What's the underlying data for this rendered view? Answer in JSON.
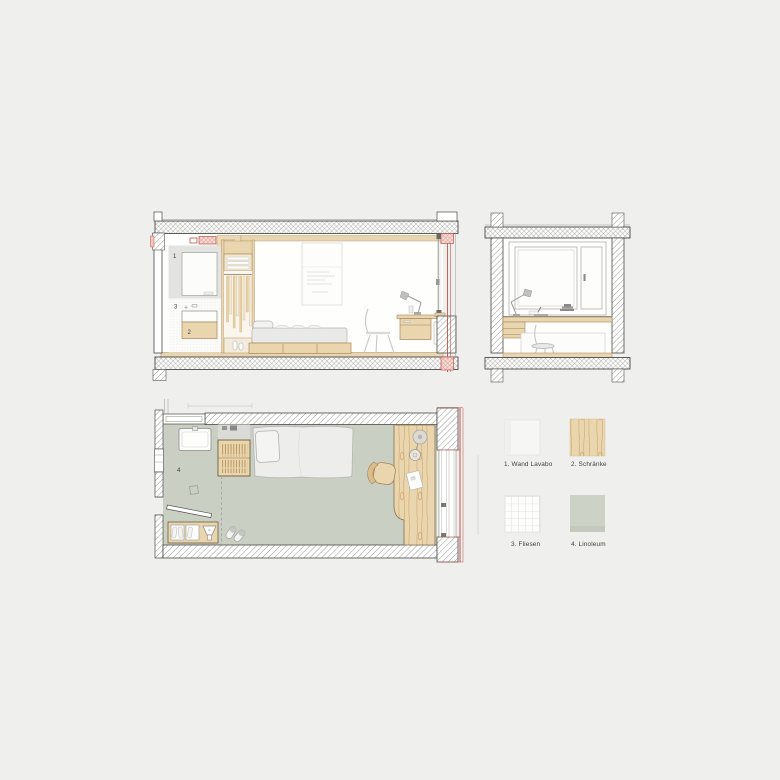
{
  "background": "#efefed",
  "palette": {
    "wood": "#e9d5ae",
    "wood_line": "#b08a55",
    "linoleum": "#c9cfc2",
    "wall_gray": "#e3e3e1",
    "accent_red": "#bd5449",
    "outline": "#4a4a47",
    "hatch_line": "#6b6b68"
  },
  "annotations": {
    "wand_lavabo": "1",
    "schraenke": "2",
    "fliesen": "3",
    "linoleum": "4"
  },
  "legend": {
    "items": [
      {
        "label": "1. Wand Lavabo"
      },
      {
        "label": "2. Schränke"
      },
      {
        "label": "3. Fliesen"
      },
      {
        "label": "4. Linoleum"
      }
    ]
  }
}
